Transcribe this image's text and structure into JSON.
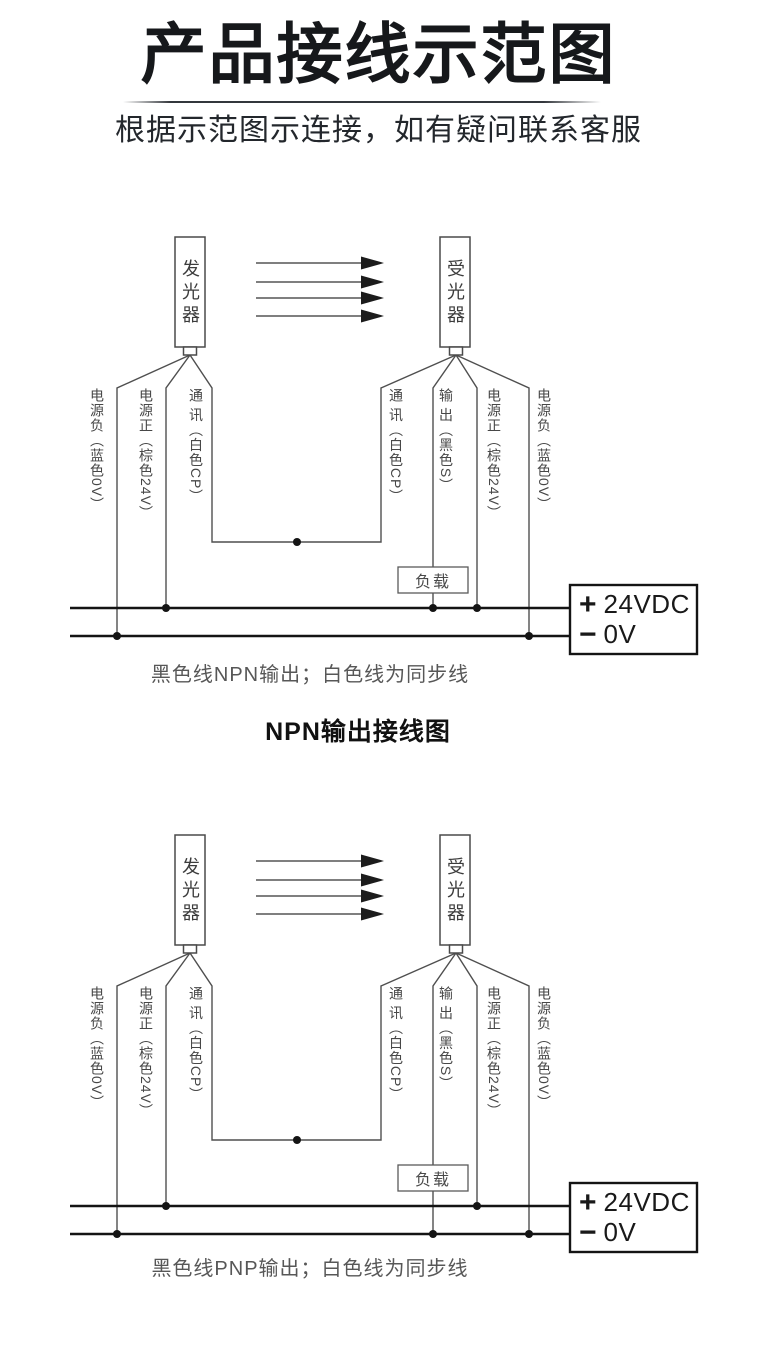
{
  "header": {
    "title": "产品接线示范图",
    "subtitle": "根据示范图示连接，如有疑问联系客服"
  },
  "device": {
    "emitter": "发光器",
    "receiver": "受光器"
  },
  "wire_labels": {
    "left": [
      "电源负（蓝色0V）",
      "电源正（棕色24V）",
      "通 讯（白色CP）"
    ],
    "right": [
      "通 讯（白色CP）",
      "输 出（黑色S）",
      "电源正（棕色24V）",
      "电源负（蓝色0V）"
    ]
  },
  "load_label": "负载",
  "power_supply": {
    "positive_symbol": "+",
    "positive_label": "24VDC",
    "negative_symbol": "−",
    "negative_label": "0V"
  },
  "sections": [
    {
      "type": "NPN",
      "caption": "黑色线NPN输出；白色线为同步线",
      "title": "NPN输出接线图"
    },
    {
      "type": "PNP",
      "caption": "黑色线PNP输出；白色线为同步线"
    }
  ],
  "colors": {
    "wire_line": "#4f4f4f",
    "bus_line": "#141414",
    "arrow_head": "#1c1c1c",
    "label_text": "#474747",
    "caption_text": "#575757",
    "title_text": "#16181b"
  }
}
